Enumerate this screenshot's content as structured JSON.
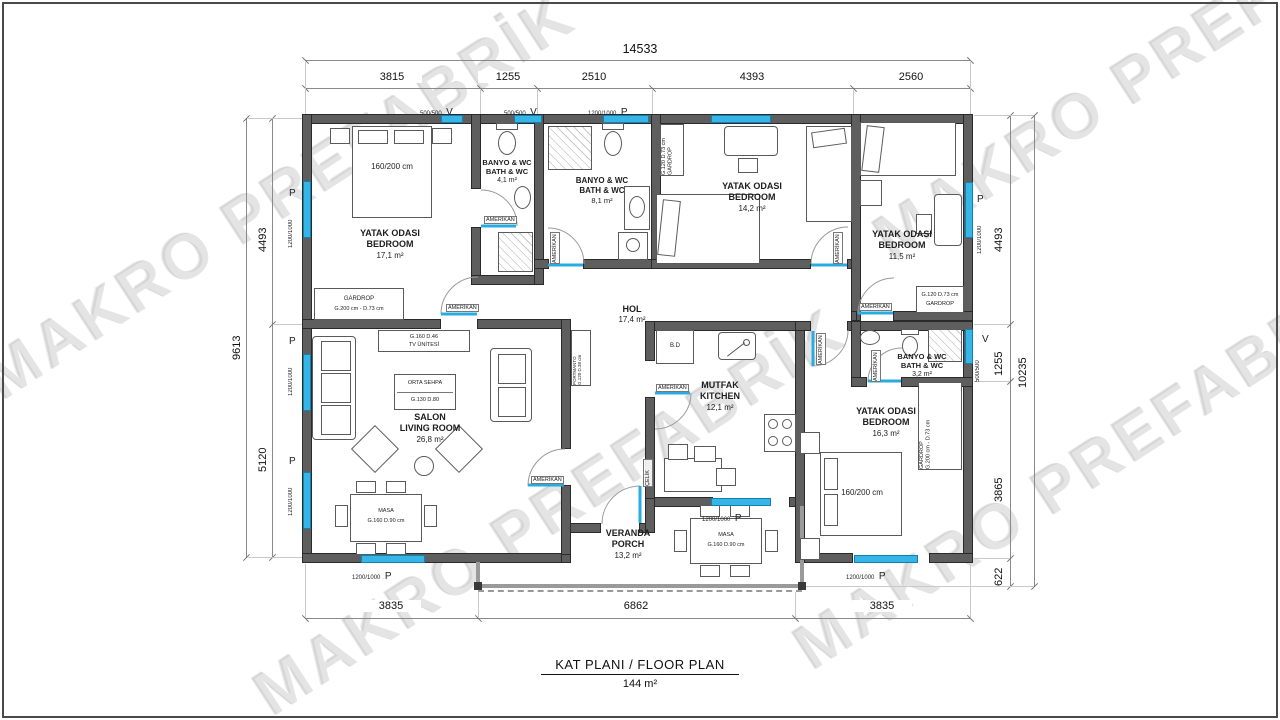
{
  "watermark": "MAKRO PREFABRİK",
  "title": {
    "line1": "KAT PLANI / FLOOR PLAN",
    "line2": "144 m²"
  },
  "dims": {
    "top_total": "14533",
    "top": [
      "3815",
      "1255",
      "2510",
      "4393",
      "2560"
    ],
    "left_total": "9613",
    "left": [
      "4493",
      "5120"
    ],
    "right_total": "10235",
    "right": [
      "4493",
      "1255",
      "3865",
      "622"
    ],
    "bottom": [
      "3835",
      "6862",
      "3835"
    ]
  },
  "rooms": {
    "bedroom1": {
      "l1": "YATAK ODASI",
      "l2": "BEDROOM",
      "l3": "17,1 m²"
    },
    "bath1": {
      "l1": "BANYO & WC",
      "l2": "BATH & WC",
      "l3": "4,1 m²"
    },
    "bath2": {
      "l1": "BANYO & WC",
      "l2": "BATH & WC",
      "l3": "8,1 m²"
    },
    "bedroom2": {
      "l1": "YATAK ODASI",
      "l2": "BEDROOM",
      "l3": "14,2 m²"
    },
    "bedroom3": {
      "l1": "YATAK ODASI",
      "l2": "BEDROOM",
      "l3": "11,5 m²"
    },
    "hol": {
      "l1": "HOL",
      "l3": "17,4 m²"
    },
    "salon": {
      "l1": "SALON",
      "l2": "LIVING ROOM",
      "l3": "26,8 m²"
    },
    "kitchen": {
      "l1": "MUTFAK",
      "l2": "KITCHEN",
      "l3": "12,1 m²"
    },
    "bedroom4": {
      "l1": "YATAK ODASI",
      "l2": "BEDROOM",
      "l3": "16,3 m²"
    },
    "bath3": {
      "l1": "BANYO & WC",
      "l2": "BATH & WC",
      "l3": "3,2 m²"
    },
    "veranda": {
      "l1": "VERANDA",
      "l2": "PORCH",
      "l3": "13,2 m²"
    }
  },
  "furniture": {
    "bed160": "160/200 cm",
    "gardrop_name": "GARDROP",
    "gardrop200_size": "G.200 cm - D.73 cm",
    "gardrop120_size": "G.120 D.73 cm",
    "tv_size": "G.160 D.46",
    "tv_name": "TV ÜNİTESİ",
    "sehpa_name": "ORTA SEHPA",
    "sehpa_size": "G.130 D.80",
    "masa_name": "MASA",
    "masa_size": "G.160 D.90 cm",
    "portmanto_name": "PORTMANTO",
    "portmanto_size": "G.120 D.38 cm",
    "bd": "B.D"
  },
  "openings": {
    "win_small": "500/500",
    "win_large": "1200/1000",
    "v": "V",
    "p": "P",
    "door_amerikan": "AMERİKAN",
    "door_celik": "ÇELİK"
  }
}
